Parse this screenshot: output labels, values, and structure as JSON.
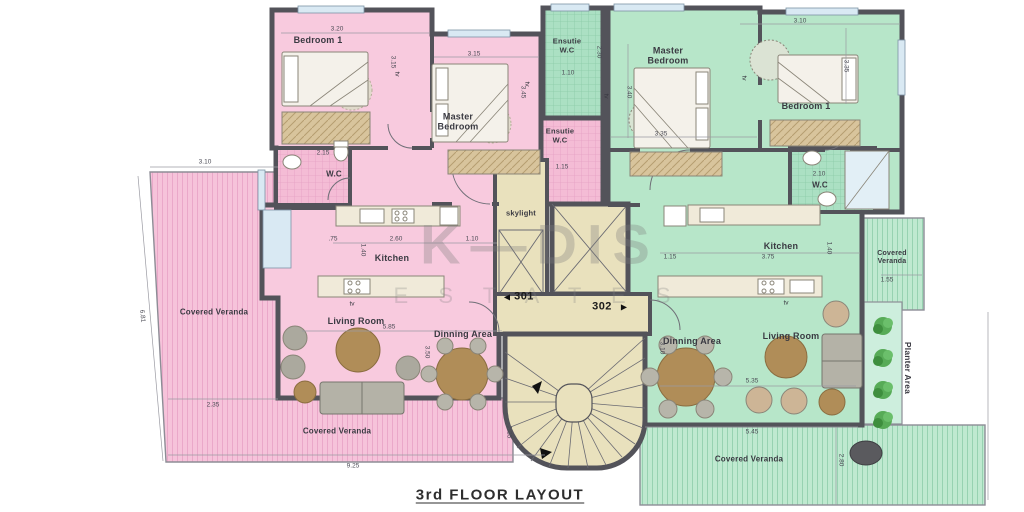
{
  "title": "3rd FLOOR LAYOUT",
  "watermark": {
    "top": "K—DIS",
    "bottom": "E S T A T E S"
  },
  "colors": {
    "apt1": "#f8cade",
    "apt2": "#b7e6c9",
    "wall": "#53535a",
    "core": "#e9e1bd"
  },
  "labels": {
    "rooms": [
      {
        "t": "Bedroom 1",
        "x": 318,
        "y": 40
      },
      {
        "t": "Master\nBedroom",
        "x": 458,
        "y": 122
      },
      {
        "t": "Ensutie\nW.C",
        "x": 567,
        "y": 46,
        "fs": 7.5
      },
      {
        "t": "Ensutie\nW.C",
        "x": 560,
        "y": 136,
        "fs": 7.5
      },
      {
        "t": "W.C",
        "x": 334,
        "y": 174,
        "fs": 8
      },
      {
        "t": "Kitchen",
        "x": 392,
        "y": 258
      },
      {
        "t": "Living Room",
        "x": 356,
        "y": 321
      },
      {
        "t": "Dinning Area",
        "x": 463,
        "y": 334
      },
      {
        "t": "Covered Veranda",
        "x": 214,
        "y": 312,
        "fs": 8
      },
      {
        "t": "Covered Veranda",
        "x": 337,
        "y": 431,
        "fs": 8
      },
      {
        "t": "skylight",
        "x": 521,
        "y": 214,
        "fs": 7.5
      },
      {
        "t": "Master\nBedroom",
        "x": 668,
        "y": 56
      },
      {
        "t": "Bedroom 1",
        "x": 806,
        "y": 106
      },
      {
        "t": "W.C",
        "x": 820,
        "y": 185,
        "fs": 8
      },
      {
        "t": "Kitchen",
        "x": 781,
        "y": 246
      },
      {
        "t": "Living Room",
        "x": 791,
        "y": 336
      },
      {
        "t": "Dinning Area",
        "x": 692,
        "y": 341
      },
      {
        "t": "Covered\nVeranda",
        "x": 892,
        "y": 258,
        "fs": 7
      },
      {
        "t": "Covered Veranda",
        "x": 749,
        "y": 459,
        "fs": 8
      },
      {
        "t": "Planter Area",
        "x": 907,
        "y": 368,
        "rot": 90,
        "fs": 8.5
      }
    ],
    "units": [
      {
        "t": "301",
        "x": 524,
        "y": 297
      },
      {
        "t": "302",
        "x": 602,
        "y": 307
      }
    ],
    "arrows": [
      {
        "t": "◀",
        "x": 507,
        "y": 297
      },
      {
        "t": "▶",
        "x": 624,
        "y": 307
      }
    ],
    "tv": [
      {
        "t": "tv",
        "x": 397,
        "y": 74,
        "rot": 90
      },
      {
        "t": "tv",
        "x": 527,
        "y": 84,
        "rot": 90
      },
      {
        "t": "tv",
        "x": 352,
        "y": 304
      },
      {
        "t": "tv",
        "x": 606,
        "y": 96,
        "rot": 90
      },
      {
        "t": "tv",
        "x": 744,
        "y": 78,
        "rot": 90
      },
      {
        "t": "tv",
        "x": 786,
        "y": 303
      }
    ],
    "dims": [
      {
        "t": "3.20",
        "x": 337,
        "y": 29
      },
      {
        "t": "3.15",
        "x": 393,
        "y": 62,
        "rot": 90
      },
      {
        "t": "3.15",
        "x": 474,
        "y": 54
      },
      {
        "t": "3.45",
        "x": 523,
        "y": 92,
        "rot": 90
      },
      {
        "t": "2.15",
        "x": 323,
        "y": 153
      },
      {
        "t": "2.30",
        "x": 599,
        "y": 52,
        "rot": 90
      },
      {
        "t": "1.10",
        "x": 568,
        "y": 73
      },
      {
        "t": "1.15",
        "x": 562,
        "y": 167
      },
      {
        "t": ".75",
        "x": 333,
        "y": 239
      },
      {
        "t": "2.60",
        "x": 396,
        "y": 239
      },
      {
        "t": "1.10",
        "x": 472,
        "y": 239
      },
      {
        "t": "1.40",
        "x": 363,
        "y": 250,
        "rot": 90
      },
      {
        "t": "5.85",
        "x": 389,
        "y": 327
      },
      {
        "t": "3.50",
        "x": 427,
        "y": 352,
        "rot": 90
      },
      {
        "t": "3.10",
        "x": 205,
        "y": 162
      },
      {
        "t": "6.81",
        "x": 142,
        "y": 316,
        "rot": 84
      },
      {
        "t": "2.35",
        "x": 213,
        "y": 405
      },
      {
        "t": "9.25",
        "x": 353,
        "y": 466
      },
      {
        "t": "1.35",
        "x": 509,
        "y": 432,
        "rot": 90
      },
      {
        "t": "3.40",
        "x": 629,
        "y": 92,
        "rot": 90
      },
      {
        "t": "3.35",
        "x": 661,
        "y": 134
      },
      {
        "t": "3.10",
        "x": 800,
        "y": 21
      },
      {
        "t": "3.35",
        "x": 846,
        "y": 66,
        "rot": 90
      },
      {
        "t": "2.10",
        "x": 819,
        "y": 174
      },
      {
        "t": "1.15",
        "x": 670,
        "y": 257
      },
      {
        "t": "3.75",
        "x": 768,
        "y": 257
      },
      {
        "t": "1.40",
        "x": 829,
        "y": 248,
        "rot": 90
      },
      {
        "t": "1.55",
        "x": 887,
        "y": 280
      },
      {
        "t": "5.35",
        "x": 752,
        "y": 381
      },
      {
        "t": "3.10",
        "x": 662,
        "y": 348,
        "rot": 90
      },
      {
        "t": "5.45",
        "x": 752,
        "y": 432
      },
      {
        "t": "2.80",
        "x": 841,
        "y": 460,
        "rot": 90
      }
    ]
  }
}
